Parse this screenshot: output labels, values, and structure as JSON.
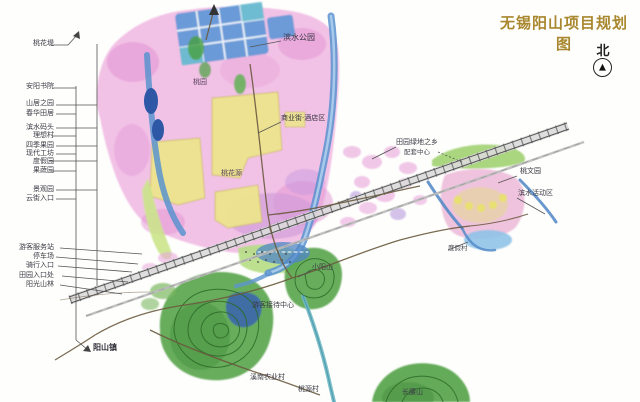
{
  "title": {
    "text": "无锡阳山项目规划图",
    "color": "#a8872e"
  },
  "compass": {
    "label": "北",
    "arrow_glyph": "▲"
  },
  "colors": {
    "accent_gold": "#a8872e",
    "area_pink": "#efb4e2",
    "parcel_yellow": "#ece48c",
    "water_blue": "#4f86c6",
    "hill_green": "#57a44b",
    "railway_gray": "#888888",
    "ink": "#3b3b46"
  },
  "left_annotations": [
    {
      "text": "桃花堤"
    },
    {
      "text": "安阳书院"
    },
    {
      "text": "山居之园"
    },
    {
      "text": "春华田居"
    },
    {
      "text": "滨水码头"
    },
    {
      "text": "理想村"
    },
    {
      "text": "四季果园"
    },
    {
      "text": "现代工坊"
    },
    {
      "text": "度假园"
    },
    {
      "text": "果蔬园"
    },
    {
      "text": "景观园"
    },
    {
      "text": "云街入口"
    },
    {
      "text": "游客服务站"
    },
    {
      "text": "停车场"
    },
    {
      "text": "骑行入口"
    },
    {
      "text": "田园入口处"
    },
    {
      "text": "阳光山林"
    }
  ],
  "map_labels": [
    {
      "text": "滨水公园"
    },
    {
      "text": "商业街·酒店区"
    },
    {
      "text": "田园绿地之乡"
    },
    {
      "text": "配套中心"
    },
    {
      "text": "桃文园"
    },
    {
      "text": "滨水活动区"
    },
    {
      "text": "度假村"
    },
    {
      "text": "小阳山"
    },
    {
      "text": "游客接待中心"
    },
    {
      "text": "阳山镇"
    },
    {
      "text": "溪南农业村"
    },
    {
      "text": "桃源村"
    },
    {
      "text": "长腰山"
    },
    {
      "text": "桃园"
    },
    {
      "text": "桃花源"
    }
  ]
}
